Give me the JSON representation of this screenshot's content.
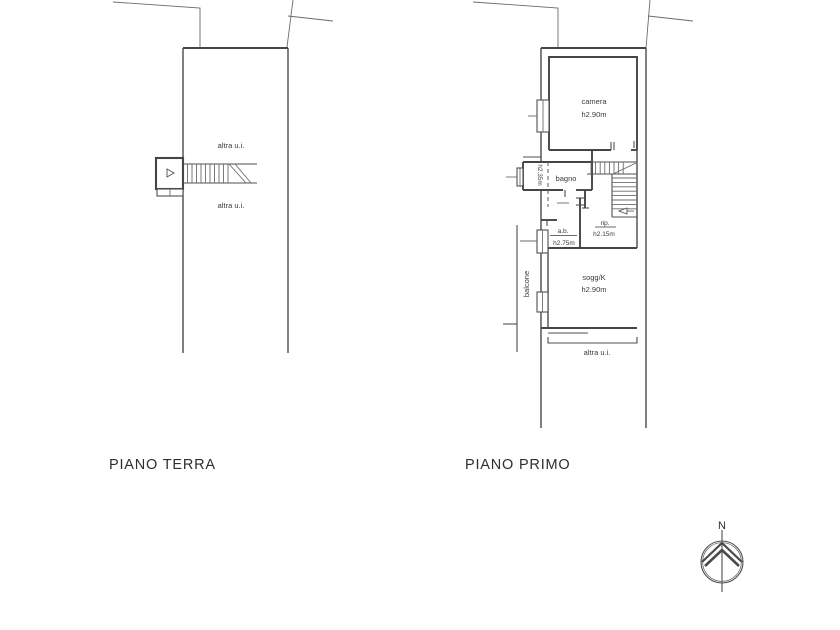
{
  "page": {
    "background_color": "#ffffff",
    "line_color": "#4f4f4f",
    "text_color": "#3a3a3a"
  },
  "plans": {
    "ground_floor": {
      "title": "PIANO TERRA",
      "labels": {
        "upper_unit": "altra u.i.",
        "lower_unit": "altra u.i."
      }
    },
    "first_floor": {
      "title": "PIANO PRIMO",
      "rooms": {
        "camera": {
          "name": "camera",
          "height": "h2.90m"
        },
        "bagno": {
          "name": "bagno"
        },
        "bagno_niche": {
          "height": "h2.35m"
        },
        "anti_bagno": {
          "name": "a.b.",
          "height": "h2.75m"
        },
        "ripostiglio": {
          "name": "rip.",
          "height": "h2.15m"
        },
        "soggiorno": {
          "name": "sogg/K",
          "height": "h2.90m"
        },
        "balcone": {
          "name": "balcone"
        }
      },
      "labels": {
        "other_unit": "altra u.i."
      }
    }
  },
  "compass": {
    "north_label": "N"
  }
}
